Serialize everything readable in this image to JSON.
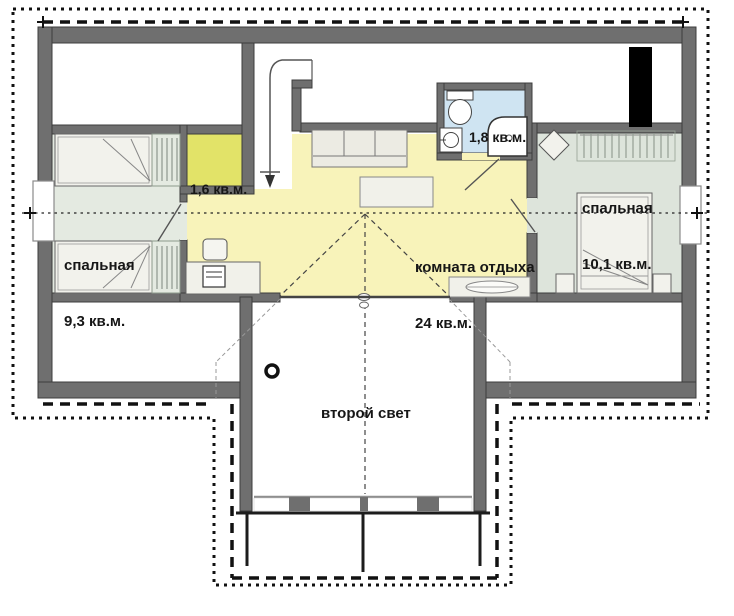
{
  "rooms": {
    "bedroom_left": {
      "name": "спальная",
      "area": "9,3 кв.м."
    },
    "closet": {
      "area": "1,6 кв.м."
    },
    "bathroom": {
      "area": "1,8 кв.м."
    },
    "lounge": {
      "name": "комната отдыха",
      "area": "24 кв.м."
    },
    "bedroom_right": {
      "name": "спальная",
      "area": "10,1 кв.м."
    },
    "second_light": {
      "name": "второй свет"
    }
  },
  "colors": {
    "wall": "#6f6f6f",
    "wall-edge": "#3c3c3c",
    "bedroom-left": "#e4eae1",
    "bedroom-right": "#dde4db",
    "closet": "#e2e368",
    "lounge": "#f8f3ba",
    "bathroom": "#cfe4f2",
    "furniture": "#f2f2ec",
    "chimney": "#000000",
    "line": "#111111"
  }
}
